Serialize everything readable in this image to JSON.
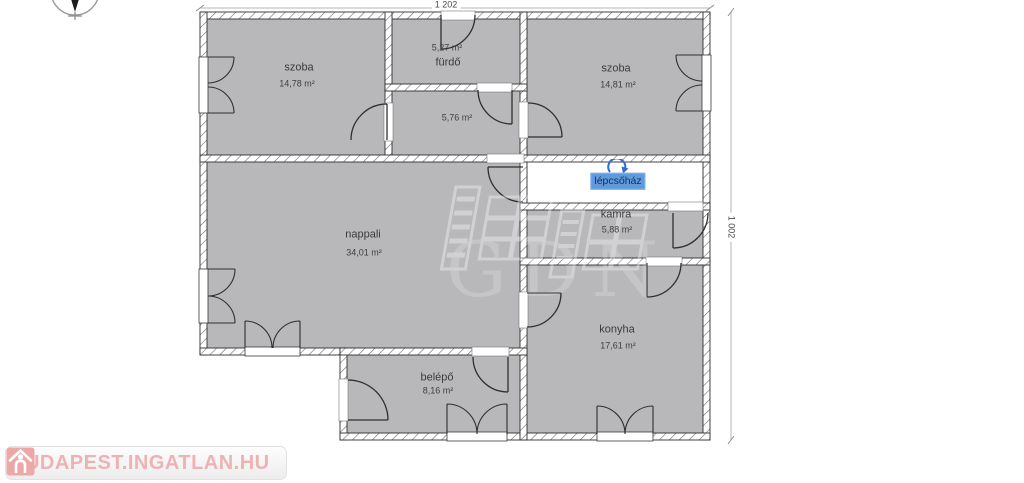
{
  "canvas": {
    "width": 1024,
    "height": 483,
    "background": "#ffffff"
  },
  "plan": {
    "watermark_text": "GDN",
    "dimension_top": "1 202",
    "dimension_right": "1 002",
    "colors": {
      "room_fill": "#b8b8bb",
      "wall_line": "#2f2f2f",
      "selection_bg": "#5e9add",
      "selection_accent": "#2e6fd0",
      "dimension_line": "#b5b5b5"
    },
    "rooms": [
      {
        "name": "szoba",
        "area": "14,78 m²"
      },
      {
        "name": "fürdő",
        "area": "5,27 m²"
      },
      {
        "name": "",
        "area": "5,76 m²"
      },
      {
        "name": "szoba",
        "area": "14,81 m²"
      },
      {
        "name": "lépcsőház",
        "area": ""
      },
      {
        "name": "kamra",
        "area": "5,88 m²"
      },
      {
        "name": "nappali",
        "area": "34,01 m²"
      },
      {
        "name": "konyha",
        "area": "17,61 m²"
      },
      {
        "name": "belépő",
        "area": "8,16 m²"
      }
    ]
  },
  "icons": {
    "compass": "north-compass-icon",
    "rotate_handle": "rotate-arrow-icon",
    "house": "house-icon"
  },
  "branding": {
    "logo_text": "BUDAPEST.INGATLAN.HU",
    "logo_color": "#efb2b2"
  }
}
